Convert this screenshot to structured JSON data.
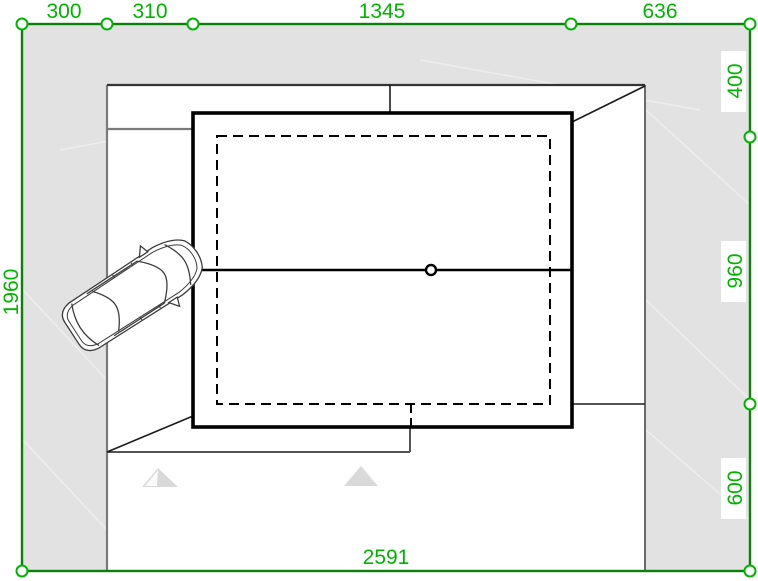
{
  "dimensions": {
    "top": [
      "300",
      "310",
      "1345",
      "636"
    ],
    "right": [
      "400",
      "960",
      "600"
    ],
    "left": [
      "1960"
    ],
    "bottom": [
      "2591"
    ]
  },
  "colors": {
    "dimension_text": "#00b400",
    "boundary_line": "#0b800b",
    "marker_stroke": "#00b400",
    "site_fill": "#e2e2e2",
    "wall_line": "#000000",
    "terrain_line": "#7a7a7a"
  }
}
